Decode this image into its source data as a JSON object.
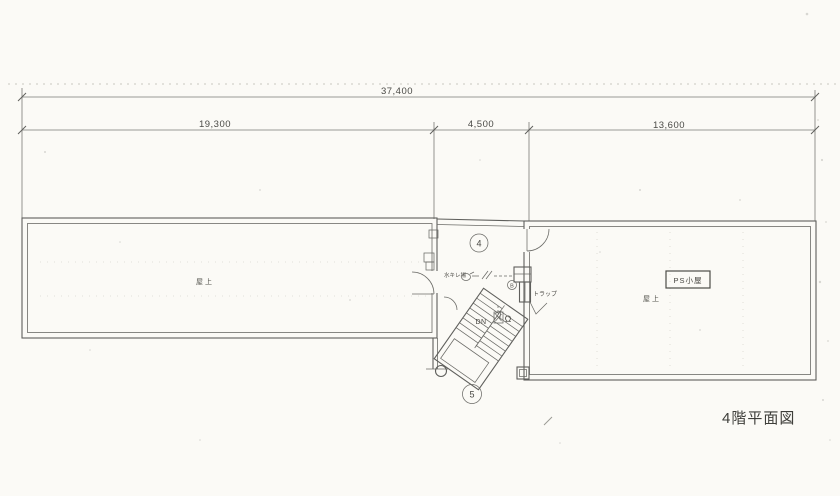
{
  "title": {
    "caption": "4階平面図"
  },
  "dimensions": {
    "overall": "37,400",
    "segment_left": "19,300",
    "segment_center": "4,500",
    "segment_right": "13,600"
  },
  "rooms": {
    "left_roof": "屋上",
    "right_roof": "屋上",
    "ps_shed": "PS小屋"
  },
  "stair": {
    "down": "DN",
    "upper_circle": "4",
    "lower_circle": "5"
  },
  "annotations": {
    "washing_area": "水キレ場",
    "trap": "トラップ",
    "drain_symbol": "Ω",
    "circled_mark": "B"
  },
  "colors": {
    "paper": "#fbfaf6",
    "line": "#5f5f5c",
    "text": "#3e3e3a"
  }
}
